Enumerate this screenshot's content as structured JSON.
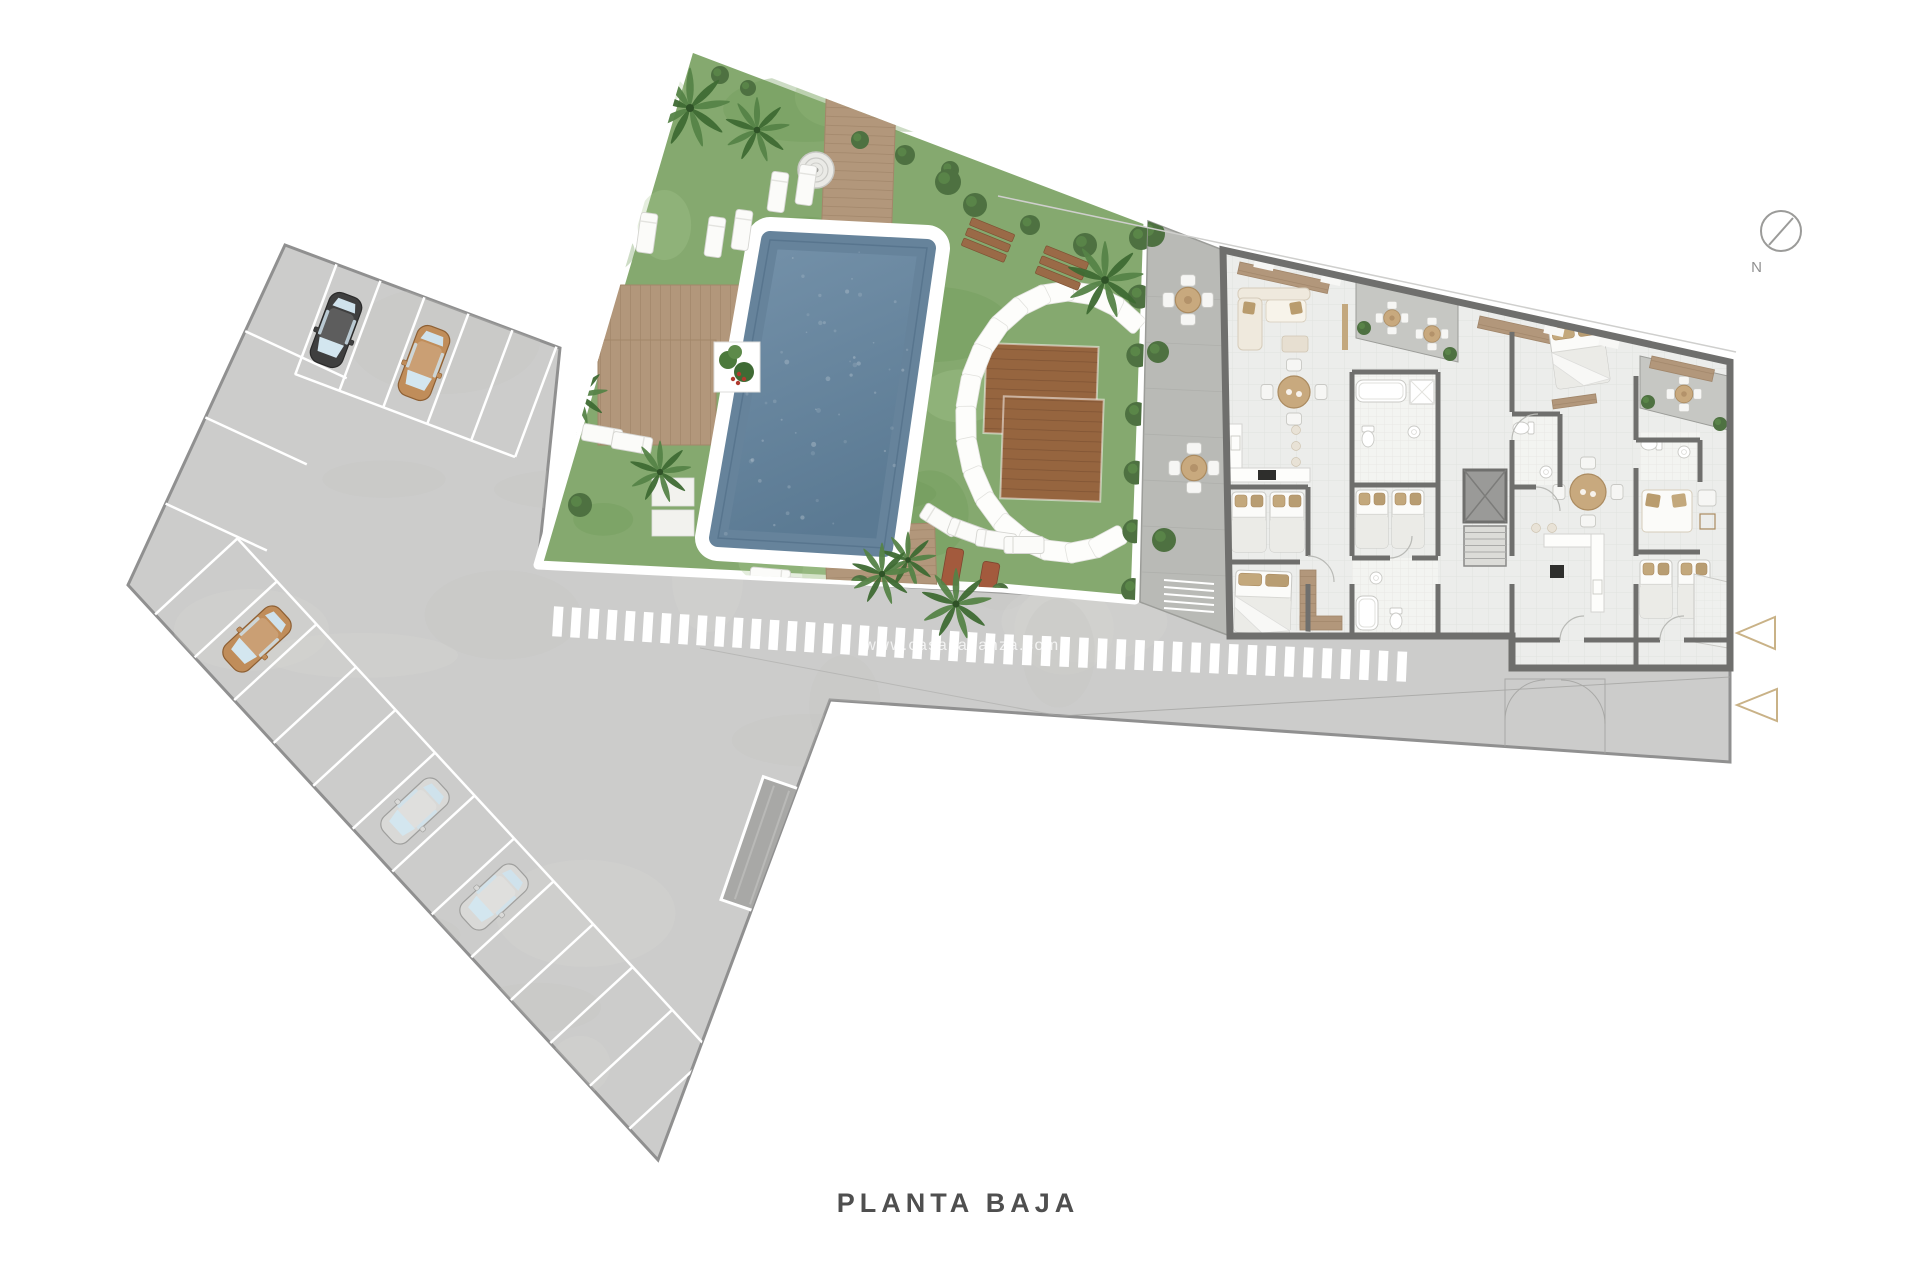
{
  "title": {
    "label": "PLANTA BAJA"
  },
  "compass": {
    "label": "N"
  },
  "watermark": {
    "text": "www.casasalianza.com"
  },
  "colors": {
    "background": "#ffffff",
    "pavement": "#cccccb",
    "pavement_edge": "#909090",
    "marking_white": "#ffffff",
    "grass": "#85a96f",
    "grass_dark": "#6f9a59",
    "grass_light": "#a9c791",
    "pool_water": "#66839b",
    "pool_water_deep": "#5b7a93",
    "pool_ring": "#ffffff",
    "wood_light": "#b2977b",
    "wood_line": "#a1866a",
    "wood_dark": "#96653f",
    "wood_dark_line": "#7e5233",
    "terrace": "#b9bab6",
    "patio": "#c6c7c3",
    "wall": "#6f6f6d",
    "floor": "#ecedeb",
    "bath_tile": "#f3f4f1",
    "cream": "#efe9dd",
    "tan_furniture": "#c8a97e",
    "pillow_tan": "#c3a87c",
    "hedge_green": "#4e7141",
    "leaf_green": "#3e6a33",
    "leaf_light": "#558347",
    "accent_gold": "#c9b287",
    "title_color": "#4f4f4f",
    "watermark_color": "#ffffff",
    "compass_color": "#909090"
  },
  "parking": {
    "cars": [
      {
        "color_name": "black",
        "hex": "#3f3f3f"
      },
      {
        "color_name": "tan",
        "hex": "#c08d5a"
      },
      {
        "color_name": "tan",
        "hex": "#c08d5a"
      },
      {
        "color_name": "silver",
        "hex": "#d9d9d7"
      },
      {
        "color_name": "silver",
        "hex": "#d9d9d7"
      }
    ]
  }
}
